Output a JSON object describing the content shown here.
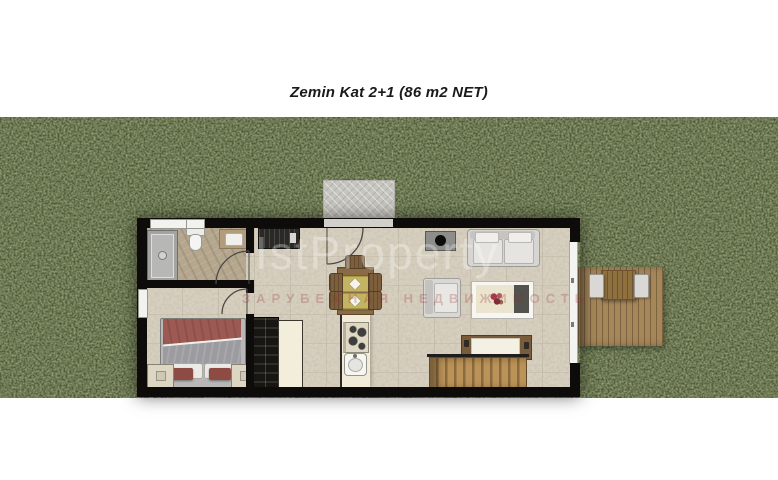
{
  "title": "Zemin Kat  2+1 (86 m2 NET)",
  "watermark": {
    "brand": "IstProperty",
    "subtitle": "ЗАРУБЕЖНАЯ НЕДВИЖИМОСТЬ"
  },
  "palette": {
    "page_bg": "#ffffff",
    "grass_base": "#4d5a33",
    "wall": "#0d0c0a",
    "floor": "#d7d0c0",
    "bathroom_floor": "#b5a68e",
    "walkway": "#c7c5bf",
    "deck_wood": "#a5875a",
    "stair_wood": "#bb9257",
    "dining_wood": "#8a6b45",
    "kitchen_counter": "#f1ebd8",
    "bed_blanket": "#9c5a52",
    "bed_duvet": "#9c9ca0",
    "sofa": "#d6d5d1",
    "placemat": "#c2b462"
  },
  "scene": {
    "floor_label": "Zemin Kat (ground floor), 2+1 layout, 86 m2 net",
    "rooms": [
      {
        "name": "bathroom",
        "furniture": [
          "shower",
          "toilet",
          "sink vanity"
        ]
      },
      {
        "name": "bedroom",
        "furniture": [
          "double bed",
          "left nightstand",
          "right nightstand"
        ]
      },
      {
        "name": "hall",
        "furniture": [
          "entrance door",
          "entry cabinet",
          "wardrobe",
          "closet"
        ]
      },
      {
        "name": "kitchen-dining",
        "furniture": [
          "counter",
          "stove",
          "sink",
          "dining table",
          "five chairs"
        ]
      },
      {
        "name": "living-room",
        "furniture": [
          "tv",
          "sofa",
          "armchair",
          "coffee table",
          "sideboard",
          "stairs"
        ]
      },
      {
        "name": "terrace",
        "furniture": [
          "wood deck",
          "outdoor table",
          "two outdoor chairs"
        ]
      }
    ]
  }
}
